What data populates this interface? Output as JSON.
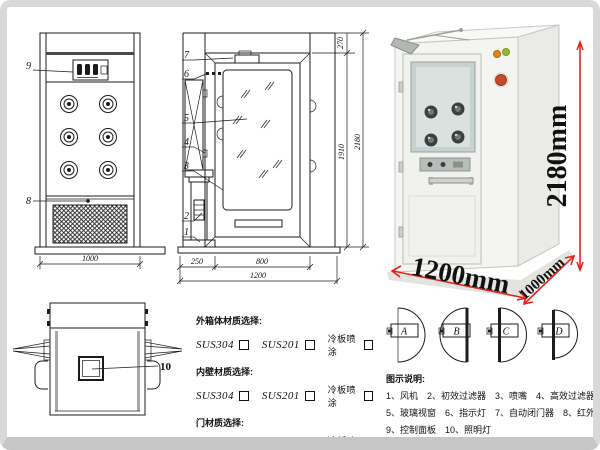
{
  "front_view": {
    "callout_panel": "9",
    "callout_grille": "8",
    "dim_width": "1000"
  },
  "top_view": {
    "callout_lamp": "10"
  },
  "side_view": {
    "callouts": [
      "7",
      "6",
      "5",
      "4",
      "3",
      "2",
      "1"
    ],
    "dim_top": "270",
    "dim_inner_height": "1910",
    "dim_total_height": "2180",
    "dim_side": "250",
    "dim_door": "800",
    "dim_total_width": "1200"
  },
  "photo": {
    "dim_height": "2180mm",
    "dim_width": "1200mm",
    "dim_depth": "1000mm",
    "dim_color": "#e8231a"
  },
  "materials": {
    "groups": [
      {
        "title": "外箱体材质选择:",
        "options": [
          "SUS304",
          "SUS201",
          "冷板喷涂"
        ]
      },
      {
        "title": "内壁材质选择:",
        "options": [
          "SUS304",
          "SUS201",
          "冷板喷涂"
        ]
      },
      {
        "title": "门材质选择:",
        "options": [
          "SUS304",
          "SUS201",
          "冷板喷涂"
        ]
      }
    ]
  },
  "door_options": {
    "labels": [
      "A",
      "B",
      "C",
      "D"
    ]
  },
  "legend": {
    "title": "图示说明:",
    "lines": [
      [
        "1、风机",
        "2、初效过滤器",
        "3、喷嘴",
        "4、高效过滤器"
      ],
      [
        "5、玻璃视窗",
        "6、指示灯",
        "7、自动闭门器",
        "8、红外线感应器"
      ],
      [
        "9、控制面板",
        "10、照明灯"
      ]
    ]
  }
}
